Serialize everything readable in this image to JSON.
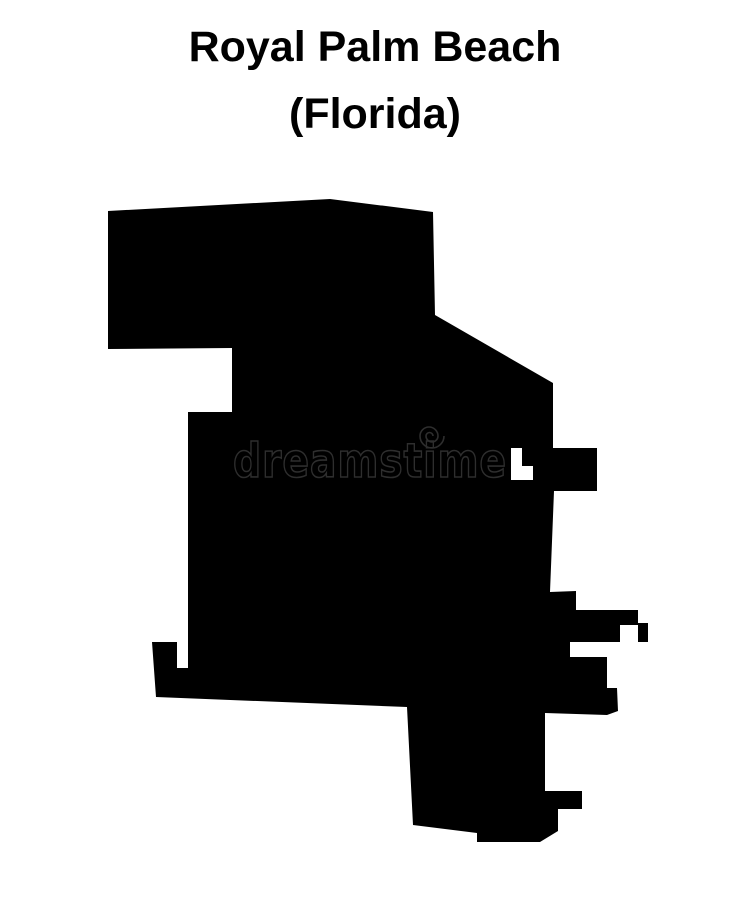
{
  "title": {
    "line1": "Royal Palm Beach",
    "line2": "(Florida)"
  },
  "map": {
    "description": "Royal Palm Beach (Florida) blank outline map silhouette",
    "fill": "#000000"
  },
  "watermark": {
    "text": "dreamstime",
    "logo": "spiral-icon"
  },
  "colors": {
    "background": "#ffffff",
    "text": "#000000",
    "silhouette": "#000000",
    "watermark_outline": "#2e2e2e"
  }
}
